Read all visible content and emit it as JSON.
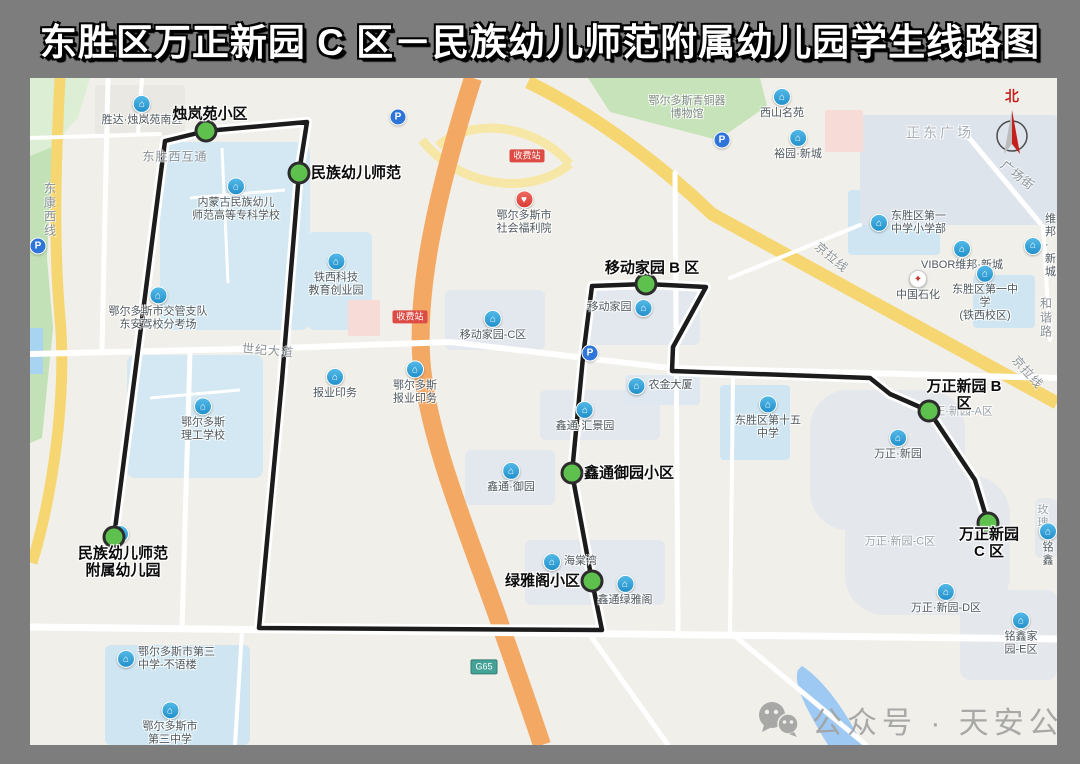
{
  "title": "东胜区万正新园 C 区－民族幼儿师范附属幼儿园学生线路图",
  "map": {
    "route": {
      "points": "84,459 135,63 176,53 277,44 269,95 252,302 229,550 572,552 562,503 542,395 553,279 562,208 616,206 676,209 643,269 642,293 840,300 860,316 899,333 945,402 958,445",
      "color": "#1c1c1c"
    },
    "stops": [
      {
        "label": "烛岚苑小区"
      },
      {
        "label": "民族幼儿师范"
      },
      {
        "label": "移动家园 B 区"
      },
      {
        "label": "万正新园 B 区"
      },
      {
        "label": "万正新园 C 区"
      },
      {
        "label": "鑫通御园小区"
      },
      {
        "label": "绿雅阁小区"
      },
      {
        "label": "民族幼儿师范\n附属幼儿园"
      }
    ],
    "pois": [
      {
        "name": "胜达·烛岚苑南区"
      },
      {
        "name": "内蒙古民族幼儿\n师范高等专科学校"
      },
      {
        "name": "铁西科技\n教育创业园"
      },
      {
        "name": "鄂尔多斯市交管支队\n东安驾校分考场"
      },
      {
        "name": "报业印务"
      },
      {
        "name": "鄂尔多斯\n报业印务"
      },
      {
        "name": "鄂尔多斯\n理工学校"
      },
      {
        "name": "鄂尔多斯市第三\n中学-不语楼"
      },
      {
        "name": "鄂尔多斯市\n第三中学"
      },
      {
        "name": "鄂尔多斯市\n社会福利院"
      },
      {
        "name": "鄂尔多斯青铜器\n博物馆"
      },
      {
        "name": "西山名苑"
      },
      {
        "name": "裕园·新城"
      },
      {
        "name": "正东广场"
      },
      {
        "name": "东胜区第一\n中学小学部"
      },
      {
        "name": "VIBOR维邦·新城"
      },
      {
        "name": "中国石化"
      },
      {
        "name": "东胜区第一中学\n(铁西校区)"
      },
      {
        "name": "维邦·新城"
      },
      {
        "name": "移动家园-C区"
      },
      {
        "name": "移动家园"
      },
      {
        "name": "农金大厦"
      },
      {
        "name": "鑫通·汇景园"
      },
      {
        "name": "鑫通·御园"
      },
      {
        "name": "海棠湾"
      },
      {
        "name": "鑫通绿雅阁"
      },
      {
        "name": "东胜区第十五\n中学"
      },
      {
        "name": "万正·新园"
      },
      {
        "name": "万正·新园-A区"
      },
      {
        "name": "万正·新园-C区"
      },
      {
        "name": "万正·新园-D区"
      },
      {
        "name": "铭鑫家园-E区"
      },
      {
        "name": "玫瑰"
      },
      {
        "name": "铭鑫"
      }
    ],
    "road_labels": [
      {
        "text": "东康西线"
      },
      {
        "text": "东胜西互通"
      },
      {
        "text": "世纪大道"
      },
      {
        "text": "广场街"
      },
      {
        "text": "京拉线"
      },
      {
        "text": "京拉线"
      },
      {
        "text": "和谐路"
      }
    ],
    "badges": [
      {
        "text": "收费站"
      },
      {
        "text": "收费站"
      },
      {
        "text": "G65"
      }
    ],
    "parking_label": "P",
    "compass_label": "北",
    "watermark": "公众号 · 天安公交"
  }
}
